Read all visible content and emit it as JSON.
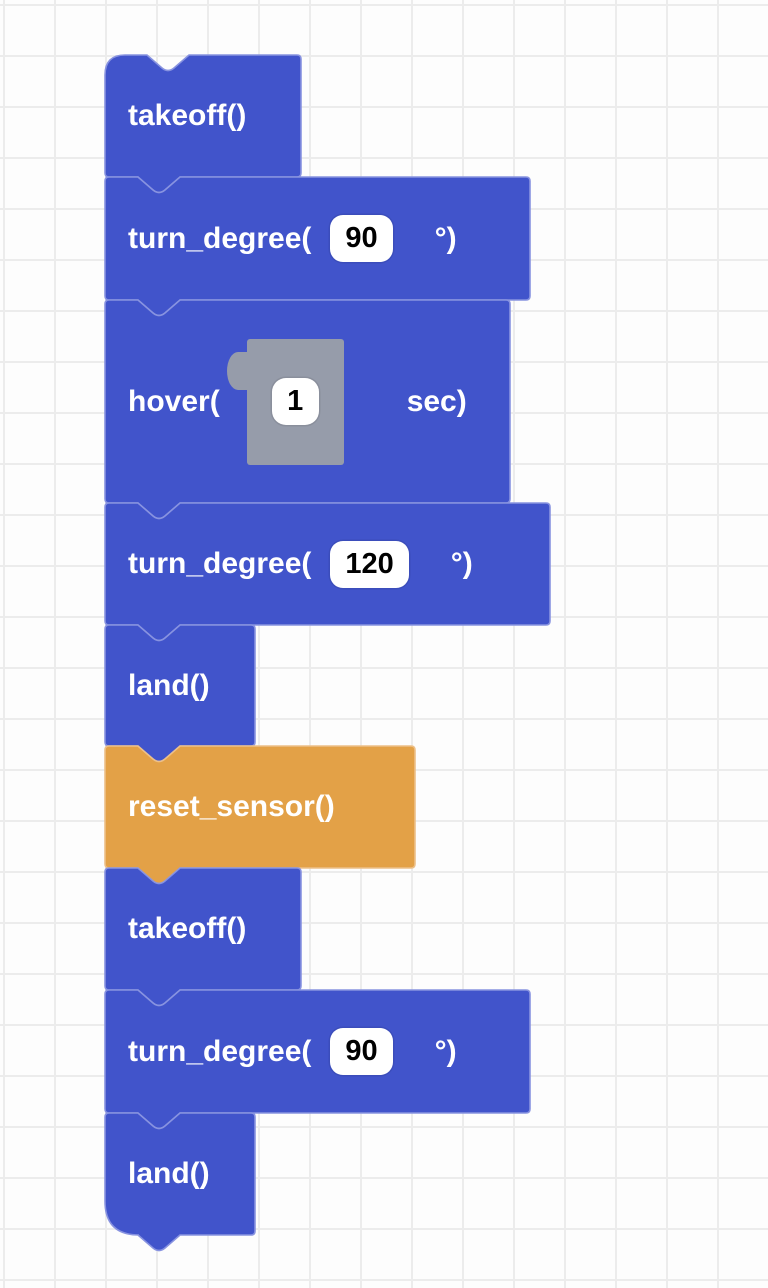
{
  "workspace": {
    "background_color": "#fdfdfd",
    "grid_line_color": "#ececec"
  },
  "palette": {
    "flight_block_fill": "#4154cb",
    "flight_block_border": "#8893e0",
    "sensor_block_fill": "#e3a147",
    "sensor_block_border": "#edc089",
    "shadow_block_fill": "#969caa",
    "field_background": "#ffffff",
    "field_text_color": "#000000",
    "label_text_color": "#ffffff"
  },
  "blocks": [
    {
      "type": "takeoff",
      "label": "takeoff()"
    },
    {
      "type": "turn_degree",
      "prefix": "turn_degree(",
      "value": "90",
      "suffix": "°)"
    },
    {
      "type": "hover",
      "prefix": "hover(",
      "value": "1",
      "suffix": "sec)"
    },
    {
      "type": "turn_degree",
      "prefix": "turn_degree(",
      "value": "120",
      "suffix": "°)"
    },
    {
      "type": "land",
      "label": "land()"
    },
    {
      "type": "reset_sensor",
      "label": "reset_sensor()"
    },
    {
      "type": "takeoff",
      "label": "takeoff()"
    },
    {
      "type": "turn_degree",
      "prefix": "turn_degree(",
      "value": "90",
      "suffix": "°)"
    },
    {
      "type": "land",
      "label": "land()"
    }
  ]
}
